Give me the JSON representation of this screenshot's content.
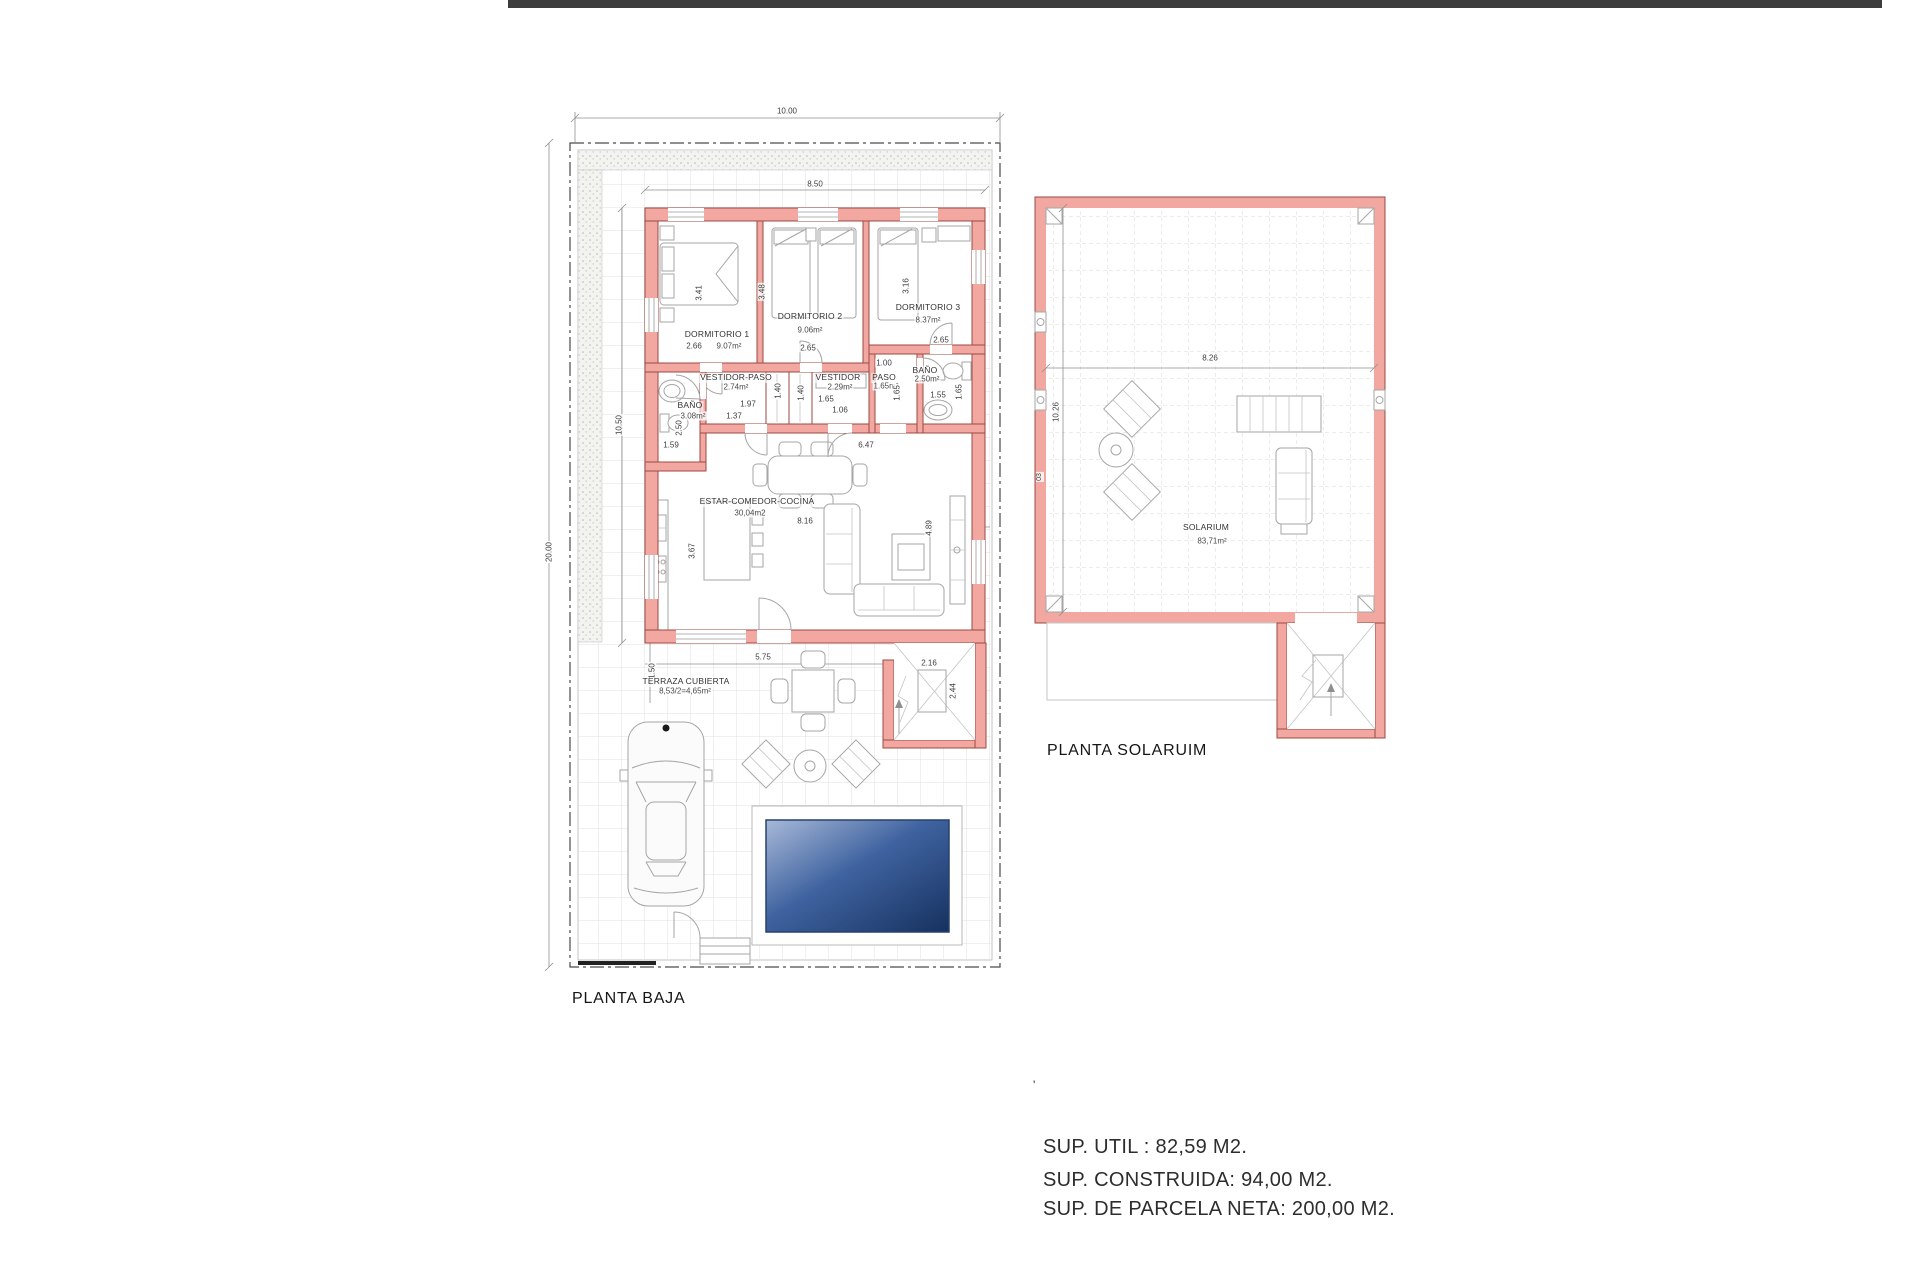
{
  "ground_floor": {
    "title": "PLANTA BAJA",
    "dims": {
      "plot_w": "10.00",
      "plot_h": "20.00",
      "bld_w": "8.50",
      "bld_h": "10.50"
    },
    "dorm1": {
      "name": "DORMITORIO 1",
      "area": "9.07m²",
      "w": "2.66",
      "h": "3.41"
    },
    "dorm2": {
      "name": "DORMITORIO 2",
      "area": "9.06m²",
      "w": "2.65",
      "h": "3.48"
    },
    "dorm3": {
      "name": "DORMITORIO 3",
      "area": "8.37m²",
      "w": "2.65",
      "h": "3.16"
    },
    "banyo1": {
      "name": "BAÑO",
      "area": "3.08m²",
      "w": "1.59",
      "h": "2.50"
    },
    "vestidor_paso": {
      "name": "VESTIDOR-PASO",
      "area": "2.74m²",
      "w1": "1.97",
      "w2": "1.37",
      "h1": "1.40",
      "h2": "1.40"
    },
    "vestidor": {
      "name": "VESTIDOR",
      "area": "2.29m²",
      "w1": "1.65",
      "w2": "1.06"
    },
    "paso": {
      "name": "PASO",
      "area": "1.65m²",
      "w": "1.00",
      "h": "1.65"
    },
    "banyo2": {
      "name": "BAÑO",
      "area": "2.50m²",
      "w": "1.55",
      "h": "1.65"
    },
    "estar": {
      "name": "ESTAR-COMEDOR-COCINA",
      "area": "30,04m2",
      "w_top": "6.47",
      "w": "8.16",
      "h_right": "4.89",
      "h_left": "3.67"
    },
    "terraza": {
      "name": "TERRAZA CUBIERTA",
      "area": "8,53/2=4,65m²",
      "w": "5.75",
      "h": "1.50"
    },
    "stairs": {
      "w": "2.16",
      "h": "2.44"
    }
  },
  "solarium": {
    "title": "PLANTA SOLARUIM",
    "name": "SOLARIUM",
    "area": "83,71m²",
    "dims": {
      "w": "8.26",
      "h": "10.26",
      "marker": "03"
    }
  },
  "summary": {
    "tick": "'",
    "lines": [
      "SUP. UTIL : 82,59 M2.",
      "SUP. CONSTRUIDA: 94,00 M2.",
      "SUP. DE PARCELA NETA: 200,00 M2."
    ]
  },
  "colors": {
    "wall_fill": "#F2A8A1",
    "wall_line": "#9B4A42",
    "pool_dark": "#16315F",
    "pool_light": "#A8B9D8"
  }
}
